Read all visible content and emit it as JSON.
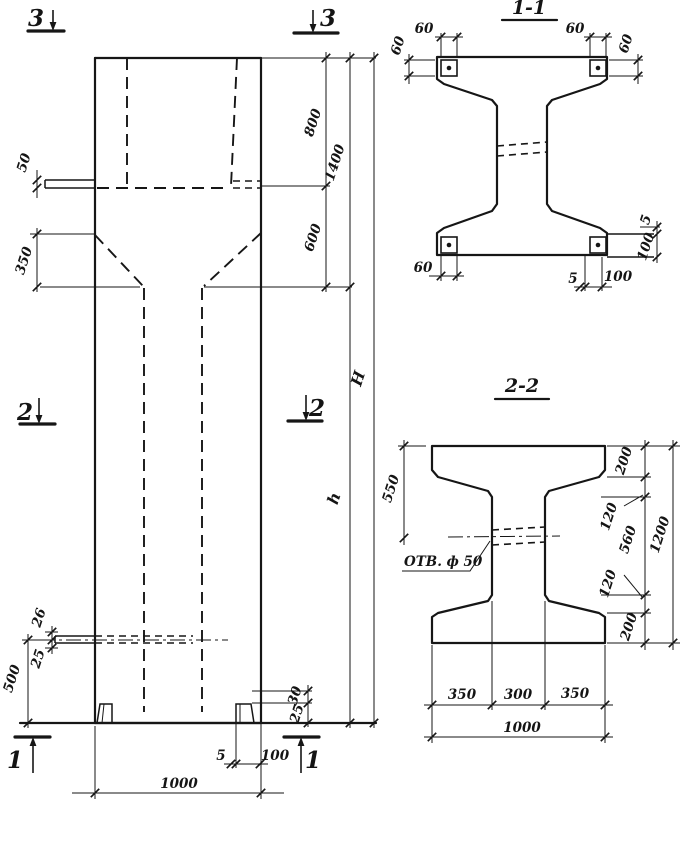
{
  "colors": {
    "line": "#161616",
    "background": "#ffffff"
  },
  "elevation": {
    "section_markers": {
      "top": "3",
      "middle": "2",
      "bottom": "1"
    },
    "dimensions": {
      "head_height": "800",
      "neck_height": "600",
      "top_total": "1400",
      "shaft_height": "h",
      "overall_height": "H",
      "ledge_thickness": "50",
      "haunch_height": "350",
      "plate_upper": "26",
      "plate_lower": "25",
      "base_height": "500",
      "foot_height": "30",
      "foot_plate": "25",
      "foot_thickness": "5",
      "foot_width": "100",
      "column_width": "1000"
    }
  },
  "section_1_1": {
    "title": "1-1",
    "dimensions": {
      "plate_width_tl": "60",
      "plate_height_tl": "60",
      "plate_width_tr": "60",
      "plate_height_tr": "60",
      "plate_width_bl": "60",
      "plate_thickness_br": "5",
      "plate_width_br": "100",
      "side_thickness": "5",
      "side_width": "100"
    }
  },
  "section_2_2": {
    "title": "2-2",
    "dimensions": {
      "top_to_hole": "550",
      "hole_note": "ОТВ. ф 50",
      "flange_top": "200",
      "taper_top": "120",
      "web_height": "560",
      "taper_bottom": "120",
      "flange_bottom": "200",
      "section_height": "1200",
      "flange_left": "350",
      "web_width": "300",
      "flange_right": "350",
      "section_width": "1000"
    }
  }
}
